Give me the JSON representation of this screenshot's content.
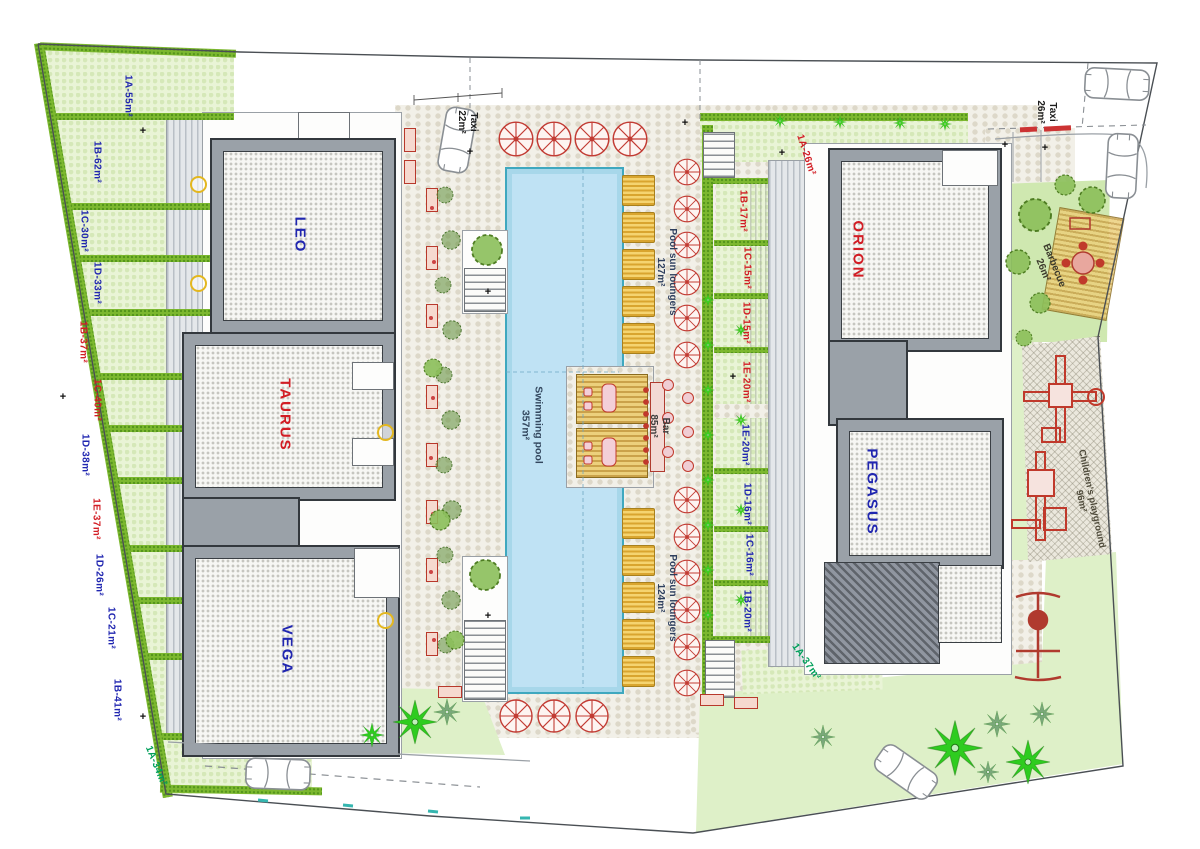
{
  "colors": {
    "red": "#d21d24",
    "blue": "#2026b0",
    "green": "#00a05a",
    "hedge": "#7cb82f",
    "pool_water": "#bfe2f4"
  },
  "buildings": [
    {
      "name": "LEO",
      "color": "blue"
    },
    {
      "name": "TAURUS",
      "color": "red"
    },
    {
      "name": "VEGA",
      "color": "blue"
    },
    {
      "name": "ORION",
      "color": "red"
    },
    {
      "name": "PEGASUS",
      "color": "blue"
    }
  ],
  "amenities": {
    "swimming_pool": {
      "label": "Swimming pool",
      "area": "357m²"
    },
    "pool_bar": {
      "label": "Bar",
      "area": "85m²"
    },
    "loungers_east": {
      "label": "Pool sun loungers",
      "area": "127m²"
    },
    "loungers_south": {
      "label": "Pool sun loungers",
      "area": "124m²"
    },
    "taxi_west": {
      "label": "Taxi",
      "area": "22m²"
    },
    "taxi_east": {
      "label": "Taxi",
      "area": "26m²"
    },
    "barbecue": {
      "label": "Barbecue",
      "area": "26m²"
    },
    "playground": {
      "label": "Children's playground",
      "area": "96m²"
    }
  },
  "west_plots": [
    {
      "label": "1A-55m²",
      "color": "blue"
    },
    {
      "label": "1B-62m²",
      "color": "blue"
    },
    {
      "label": "1C-30m²",
      "color": "blue"
    },
    {
      "label": "1D-33m²",
      "color": "blue"
    },
    {
      "label": "1B-37m²",
      "color": "red"
    },
    {
      "label": "1C-40m²",
      "color": "red"
    },
    {
      "label": "1D-38m²",
      "color": "blue"
    },
    {
      "label": "1E-37m²",
      "color": "red"
    },
    {
      "label": "1D-26m²",
      "color": "blue"
    },
    {
      "label": "1C-21m²",
      "color": "blue"
    },
    {
      "label": "1B-41m²",
      "color": "blue"
    },
    {
      "label": "1A-34m²",
      "color": "green"
    }
  ],
  "east_plots": [
    {
      "label": "1A-26m²",
      "color": "red"
    },
    {
      "label": "1B-17m²",
      "color": "red"
    },
    {
      "label": "1C-15m²",
      "color": "red"
    },
    {
      "label": "1D-15m²",
      "color": "red"
    },
    {
      "label": "1E-20m²",
      "color": "red"
    },
    {
      "label": "1E-20m²",
      "color": "blue"
    },
    {
      "label": "1D-16m²",
      "color": "blue"
    },
    {
      "label": "1C-16m²",
      "color": "blue"
    },
    {
      "label": "1B-20m²",
      "color": "blue"
    },
    {
      "label": "1A-37m²",
      "color": "green"
    }
  ]
}
